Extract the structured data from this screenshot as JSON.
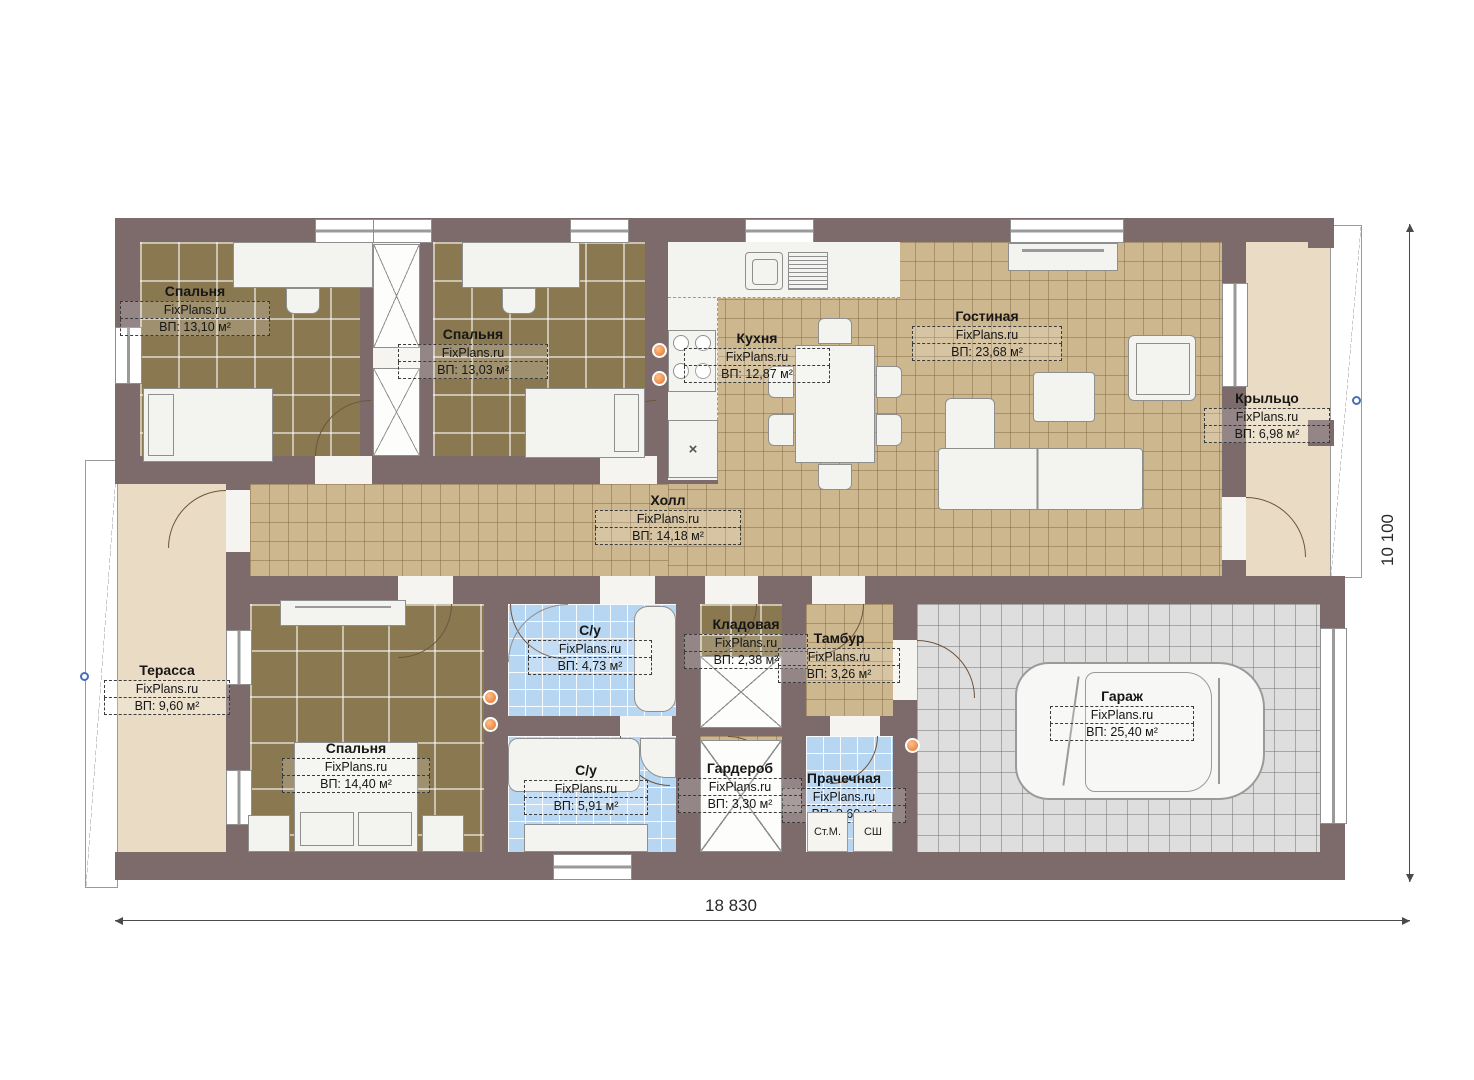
{
  "plan": {
    "watermark": "FixPlans.ru",
    "kitchen_mark": "×",
    "rooms": {
      "bedroom1": {
        "name": "Спальня",
        "area": "ВП: 13,10 м²"
      },
      "bedroom2": {
        "name": "Спальня",
        "area": "ВП: 13,03 м²"
      },
      "kitchen": {
        "name": "Кухня",
        "area": "ВП: 12,87 м²"
      },
      "living": {
        "name": "Гостиная",
        "area": "ВП: 23,68 м²"
      },
      "porch": {
        "name": "Крыльцо",
        "area": "ВП: 6,98 м²"
      },
      "hall": {
        "name": "Холл",
        "area": "ВП: 14,18 м²"
      },
      "terrace": {
        "name": "Терасса",
        "area": "ВП: 9,60 м²"
      },
      "bedroom3": {
        "name": "Спальня",
        "area": "ВП: 14,40 м²"
      },
      "bath1": {
        "name": "С/у",
        "area": "ВП: 4,73 м²"
      },
      "storage": {
        "name": "Кладовая",
        "area": "ВП: 2,38 м²"
      },
      "vestibule": {
        "name": "Тамбур",
        "area": "ВП: 3,26 м²"
      },
      "bath2": {
        "name": "С/у",
        "area": "ВП: 5,91 м²"
      },
      "wardrobe": {
        "name": "Гардероб",
        "area": "ВП: 3,30 м²"
      },
      "laundry": {
        "name": "Прачечная",
        "area": "ВП: 2,60 м²"
      },
      "garage": {
        "name": "Гараж",
        "area": "ВП: 25,40 м²"
      }
    },
    "appliances": {
      "washer": "Ст.М.",
      "dryer": "СШ"
    },
    "dimensions": {
      "width": "18 830",
      "height": "10 100"
    }
  }
}
